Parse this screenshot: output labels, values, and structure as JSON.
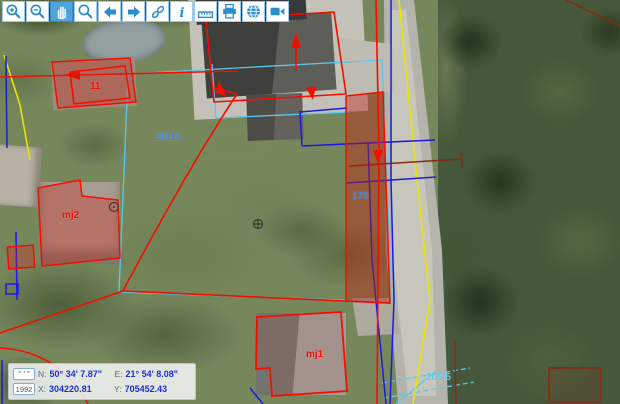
{
  "toolbar": {
    "buttons": [
      {
        "name": "zoom-in",
        "icon": "magnifier-plus-icon",
        "selected": false
      },
      {
        "name": "zoom-out",
        "icon": "magnifier-minus-icon",
        "selected": false
      },
      {
        "name": "pan",
        "icon": "hand-icon",
        "selected": true
      },
      {
        "name": "zoom-window",
        "icon": "magnifier-icon",
        "selected": false
      },
      {
        "name": "previous-view",
        "icon": "arrow-left-icon",
        "selected": false
      },
      {
        "name": "next-view",
        "icon": "arrow-right-icon",
        "selected": false
      },
      {
        "name": "link",
        "icon": "link-icon",
        "selected": false
      },
      {
        "name": "identify",
        "icon": "info-icon",
        "selected": false
      },
      {
        "name": "measure",
        "icon": "ruler-icon",
        "selected": false
      },
      {
        "name": "print",
        "icon": "printer-icon",
        "selected": false
      },
      {
        "name": "full-extent",
        "icon": "globe-icon",
        "selected": false
      },
      {
        "name": "video",
        "icon": "camera-icon",
        "selected": false
      }
    ]
  },
  "map": {
    "labels": [
      {
        "text": "11",
        "kind": "building"
      },
      {
        "text": "mj2",
        "kind": "building"
      },
      {
        "text": "mj1",
        "kind": "building"
      },
      {
        "text": "38/13",
        "kind": "parcel"
      },
      {
        "text": "170",
        "kind": "parcel"
      },
      {
        "text": "105/5",
        "kind": "parcel"
      }
    ]
  },
  "statusbar": {
    "dms_button": "° ′ ″",
    "crs_button": "1992",
    "n_label": "N:",
    "n_value": "50° 34' 7.87\"",
    "e_label": "E:",
    "e_value": "21° 54' 8.08\"",
    "x_label": "X:",
    "x_value": "304220.81",
    "y_label": "Y:",
    "y_value": "705452.43"
  },
  "colors": {
    "red": "#f20f00",
    "blue": "#1a1ae0",
    "cyan": "#5cc6f0",
    "yellow": "#e8e400",
    "maroon": "#8a2a10",
    "icon": "#2a8dd0",
    "selbg": "#4da3dc",
    "val": "#1e2fd4"
  }
}
